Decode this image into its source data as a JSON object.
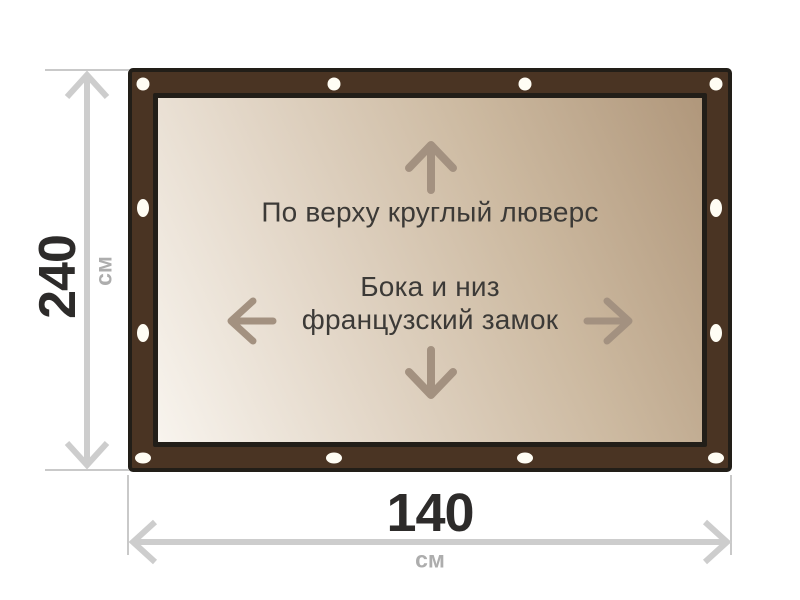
{
  "banner": {
    "label_top": "По верху круглый люверс",
    "label_center_line1": "Бока и низ",
    "label_center_line2": "французский замок",
    "eyelet_count": 12
  },
  "dimensions": {
    "height": {
      "value": "240",
      "unit": "см"
    },
    "width": {
      "value": "140",
      "unit": "см"
    }
  },
  "icons": {
    "arrow-up-icon": "↑",
    "arrow-down-icon": "↓",
    "arrow-left-icon": "←",
    "arrow-right-icon": "→",
    "height-dimension-arrow": "↕",
    "width-dimension-arrow": "↔",
    "eyelet": "○"
  },
  "colors": {
    "frame_brown": "#4a3423",
    "frame_outline": "#221e18",
    "canvas_gradient_light": "#f8f4ee",
    "canvas_gradient_dark": "#b0977b",
    "inner_text": "#3c3a37",
    "inner_arrow": "#a39180",
    "dimension_value": "#2d2b2a",
    "dimension_unit": "#adadad",
    "dimension_line": "#cdcdcd",
    "eyelet_fill": "#fffdf4",
    "background": "#ffffff"
  }
}
